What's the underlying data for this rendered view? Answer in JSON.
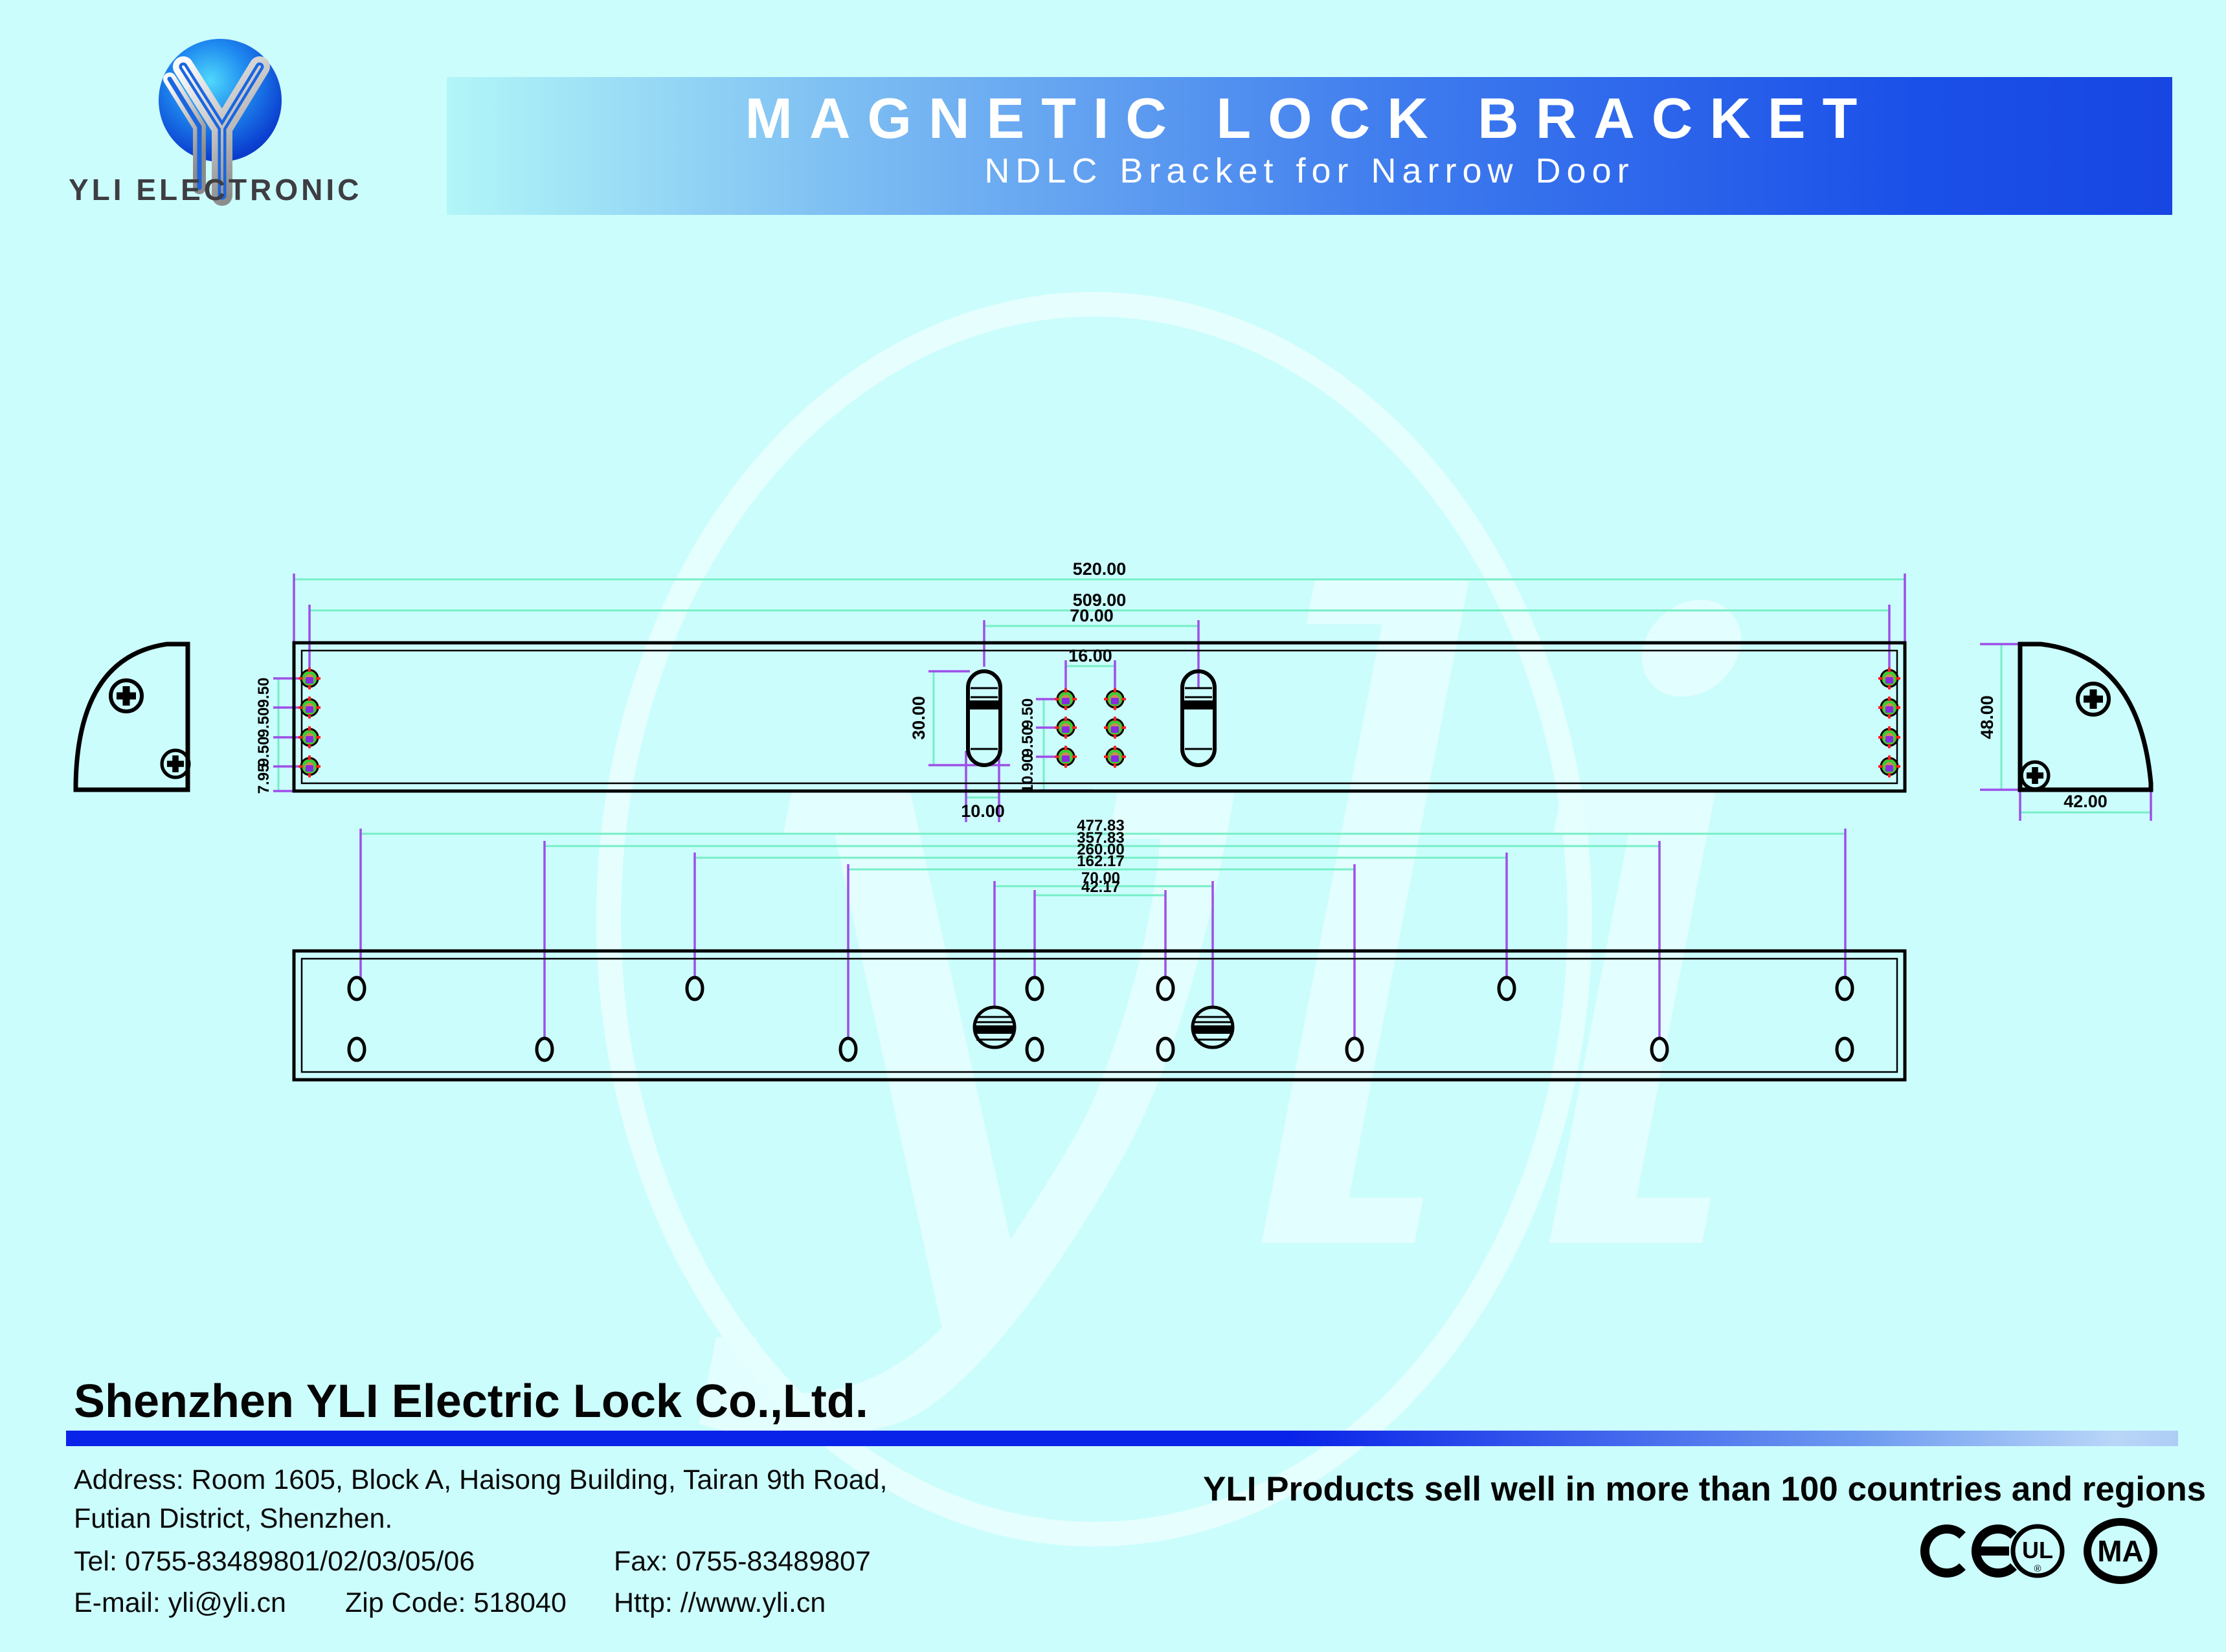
{
  "page": {
    "background": "#ccfdfd"
  },
  "logo": {
    "name": "YLI ELECTRONIC"
  },
  "banner": {
    "title": "MAGNETIC LOCK BRACKET",
    "subtitle": "NDLC Bracket for Narrow Door"
  },
  "watermark": {
    "text": "yli"
  },
  "drawing": {
    "colors": {
      "outline": "#000000",
      "dimension_line": "#76eec6",
      "extension_line": "#9d4fe8",
      "hole_fill": "#cf8b55",
      "hole_ring": "#2fd32f",
      "hole_center": "#8a2be2",
      "hole_tick": "#ff2020"
    },
    "top_view": {
      "overall_width": "520.00",
      "hole_span": "509.00",
      "slot_spacing": "70.00",
      "center_hole_spacing": "16.00",
      "slot_length": "30.00",
      "slot_width": "10.00",
      "left_hole_dims": [
        "9.50",
        "9.50",
        "9.50",
        "7.95"
      ],
      "center_hole_dims": [
        "9.50",
        "9.50",
        "10.90"
      ]
    },
    "end_view": {
      "height": "48.00",
      "width": "42.00"
    },
    "bottom_view": {
      "dims": [
        "477.83",
        "357.83",
        "260.00",
        "162.17",
        "70.00",
        "42.17"
      ]
    }
  },
  "footer": {
    "company": "Shenzhen YLI Electric Lock Co.,Ltd.",
    "address_line1": "Address: Room 1605, Block A, Haisong Building, Tairan 9th Road,",
    "address_line2": "Futian District, Shenzhen.",
    "tel": "Tel: 0755-83489801/02/03/05/06",
    "fax": "Fax: 0755-83489807",
    "email": "E-mail: yli@yli.cn",
    "zip": "Zip Code: 518040",
    "web": "Http: //www.yli.cn",
    "tagline": "YLI Products sell well in more than 100 countries and regions",
    "cert_ul": "UL",
    "cert_ma": "MA",
    "cert_reg": "®"
  }
}
